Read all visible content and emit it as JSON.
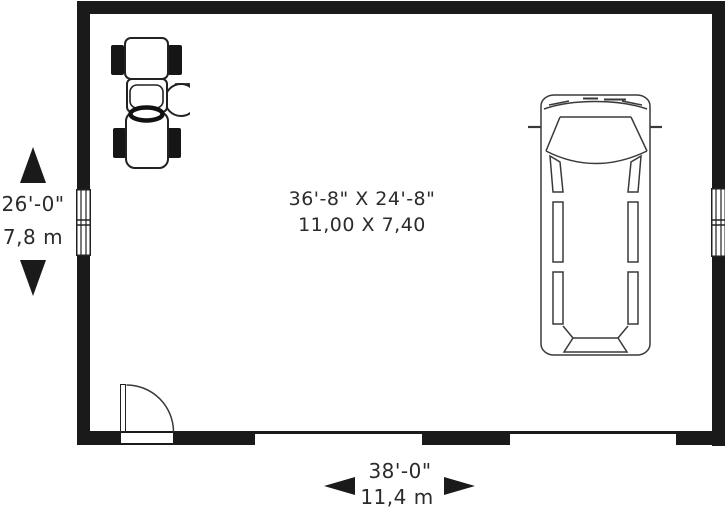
{
  "plan": {
    "title": "garage-floor-plan",
    "area_label": {
      "imperial": "36'-8\" X 24'-8\"",
      "metric": "11,00 X 7,40"
    },
    "dimensions": {
      "depth": {
        "imperial": "26'-0\"",
        "metric": "7,8 m"
      },
      "width": {
        "imperial": "38'-0\"",
        "metric": "11,4 m"
      }
    },
    "features": {
      "icons": [
        "tractor-icon",
        "van-icon"
      ],
      "openings": [
        "entry-door",
        "garage-door-opening-1",
        "garage-door-opening-2",
        "window-left",
        "window-right"
      ]
    },
    "colors": {
      "wall": "#1a1a1a",
      "line": "#333333",
      "background": "#ffffff"
    }
  }
}
